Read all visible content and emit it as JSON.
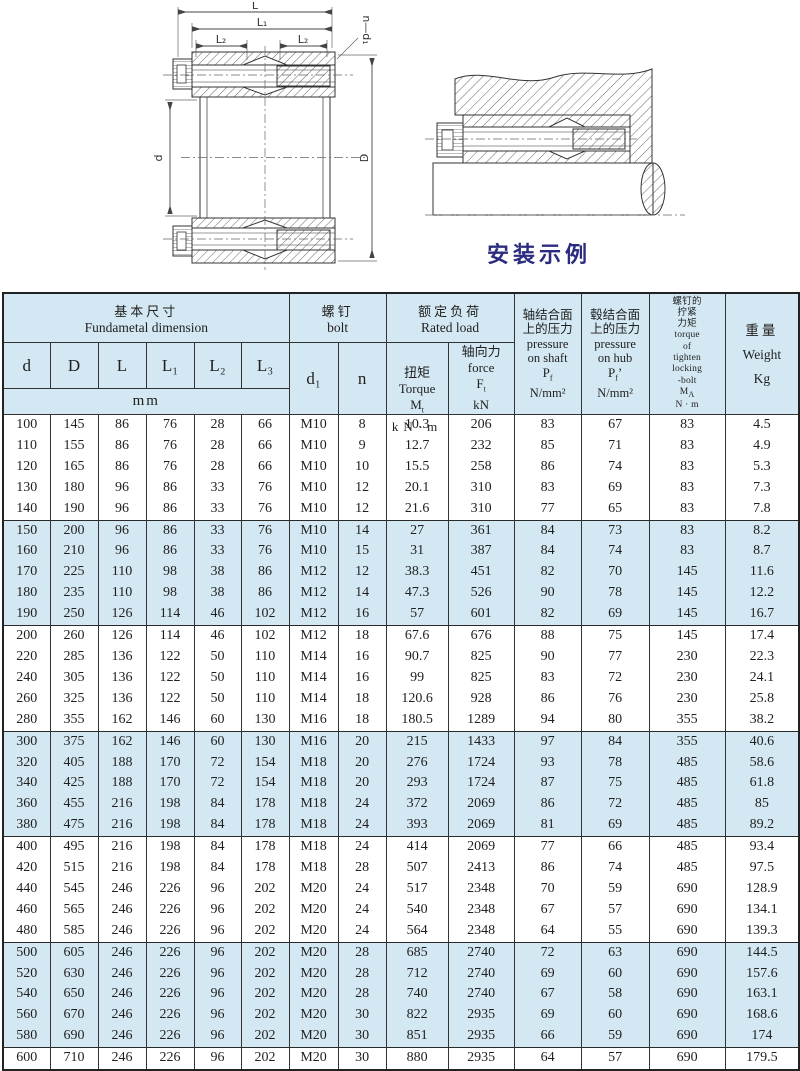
{
  "drawings": {
    "caption": "安装示例"
  },
  "drawing_labels": {
    "L": "L",
    "L1": "L₁",
    "L2": "L₂",
    "L2b": "L₂",
    "L3": "L₃",
    "n_d1": "n—d₁",
    "d": "d",
    "D": "D"
  },
  "table": {
    "col_keys": [
      "d",
      "D",
      "L",
      "L1",
      "L2",
      "L3",
      "d1",
      "n",
      "torque",
      "force",
      "p_shaft",
      "p_hub",
      "ma",
      "weight"
    ],
    "header": {
      "basic": {
        "zh": "基本尺寸",
        "en": "Fundametal  dimension"
      },
      "dims": [
        "d",
        "D",
        "L",
        "L₁",
        "L₂",
        "L₃"
      ],
      "mm": "mm",
      "bolt": {
        "zh": "螺钉",
        "en": "bolt",
        "d1": "d₁",
        "n": "n"
      },
      "rated": {
        "zh": "额定负荷",
        "en": "Rated load"
      },
      "torque": {
        "zh": "扭矩",
        "en": "Torque",
        "sym": {
          "base": "M",
          "sub": "t"
        },
        "unit": "kN·m"
      },
      "force": {
        "zh": "轴向力",
        "en": "force",
        "sym": {
          "base": "F",
          "sub": "t"
        },
        "unit": "kN"
      },
      "p_shaft": {
        "lines": [
          "轴结合面",
          "上的压力",
          "pressure",
          "on shaft"
        ],
        "sym": {
          "base": "P",
          "sub": "f"
        },
        "unit": "N/mm²"
      },
      "p_hub": {
        "lines": [
          "毂结合面",
          "上的压力",
          "pressure",
          "on hub"
        ],
        "sym": {
          "base": "P",
          "sub": "f",
          "after": "’"
        },
        "unit": "N/mm²"
      },
      "bolt_torque": {
        "lines": [
          "螺钉的",
          "拧紧",
          "力矩",
          "torque",
          "of",
          "tighten",
          "locking",
          "-bolt"
        ],
        "sym": {
          "base": "M",
          "sub": "A"
        },
        "unit": "N · m"
      },
      "weight": {
        "zh": "重量",
        "en": "Weight",
        "unit": "Kg"
      }
    },
    "rows": [
      [
        100,
        145,
        86,
        76,
        28,
        66,
        "M10",
        8,
        "10.3",
        206,
        83,
        67,
        83,
        "4.5"
      ],
      [
        110,
        155,
        86,
        76,
        28,
        66,
        "M10",
        9,
        "12.7",
        232,
        85,
        71,
        83,
        "4.9"
      ],
      [
        120,
        165,
        86,
        76,
        28,
        66,
        "M10",
        10,
        "15.5",
        258,
        86,
        74,
        83,
        "5.3"
      ],
      [
        130,
        180,
        96,
        86,
        33,
        76,
        "M10",
        12,
        "20.1",
        310,
        83,
        69,
        83,
        "7.3"
      ],
      [
        140,
        190,
        96,
        86,
        33,
        76,
        "M10",
        12,
        "21.6",
        310,
        77,
        65,
        83,
        "7.8"
      ],
      [
        150,
        200,
        96,
        86,
        33,
        76,
        "M10",
        14,
        "27",
        361,
        84,
        73,
        83,
        "8.2"
      ],
      [
        160,
        210,
        96,
        86,
        33,
        76,
        "M10",
        15,
        "31",
        387,
        84,
        74,
        83,
        "8.7"
      ],
      [
        170,
        225,
        110,
        98,
        38,
        86,
        "M12",
        12,
        "38.3",
        451,
        82,
        70,
        145,
        "11.6"
      ],
      [
        180,
        235,
        110,
        98,
        38,
        86,
        "M12",
        14,
        "47.3",
        526,
        90,
        78,
        145,
        "12.2"
      ],
      [
        190,
        250,
        126,
        114,
        46,
        102,
        "M12",
        16,
        "57",
        601,
        82,
        69,
        145,
        "16.7"
      ],
      [
        200,
        260,
        126,
        114,
        46,
        102,
        "M12",
        18,
        "67.6",
        676,
        88,
        75,
        145,
        "17.4"
      ],
      [
        220,
        285,
        136,
        122,
        50,
        110,
        "M14",
        16,
        "90.7",
        825,
        90,
        77,
        230,
        "22.3"
      ],
      [
        240,
        305,
        136,
        122,
        50,
        110,
        "M14",
        16,
        "99",
        825,
        83,
        72,
        230,
        "24.1"
      ],
      [
        260,
        325,
        136,
        122,
        50,
        110,
        "M14",
        18,
        "120.6",
        928,
        86,
        76,
        230,
        "25.8"
      ],
      [
        280,
        355,
        162,
        146,
        60,
        130,
        "M16",
        18,
        "180.5",
        1289,
        94,
        80,
        355,
        "38.2"
      ],
      [
        300,
        375,
        162,
        146,
        60,
        130,
        "M16",
        20,
        "215",
        1433,
        97,
        84,
        355,
        "40.6"
      ],
      [
        320,
        405,
        188,
        170,
        72,
        154,
        "M18",
        20,
        "276",
        1724,
        93,
        78,
        485,
        "58.6"
      ],
      [
        340,
        425,
        188,
        170,
        72,
        154,
        "M18",
        20,
        "293",
        1724,
        87,
        75,
        485,
        "61.8"
      ],
      [
        360,
        455,
        216,
        198,
        84,
        178,
        "M18",
        24,
        "372",
        2069,
        86,
        72,
        485,
        "85"
      ],
      [
        380,
        475,
        216,
        198,
        84,
        178,
        "M18",
        24,
        "393",
        2069,
        81,
        69,
        485,
        "89.2"
      ],
      [
        400,
        495,
        216,
        198,
        84,
        178,
        "M18",
        24,
        "414",
        2069,
        77,
        66,
        485,
        "93.4"
      ],
      [
        420,
        515,
        216,
        198,
        84,
        178,
        "M18",
        28,
        "507",
        2413,
        86,
        74,
        485,
        "97.5"
      ],
      [
        440,
        545,
        246,
        226,
        96,
        202,
        "M20",
        24,
        "517",
        2348,
        70,
        59,
        690,
        "128.9"
      ],
      [
        460,
        565,
        246,
        226,
        96,
        202,
        "M20",
        24,
        "540",
        2348,
        67,
        57,
        690,
        "134.1"
      ],
      [
        480,
        585,
        246,
        226,
        96,
        202,
        "M20",
        24,
        "564",
        2348,
        64,
        55,
        690,
        "139.3"
      ],
      [
        500,
        605,
        246,
        226,
        96,
        202,
        "M20",
        28,
        "685",
        2740,
        72,
        63,
        690,
        "144.5"
      ],
      [
        520,
        630,
        246,
        226,
        96,
        202,
        "M20",
        28,
        "712",
        2740,
        69,
        60,
        690,
        "157.6"
      ],
      [
        540,
        650,
        246,
        226,
        96,
        202,
        "M20",
        28,
        "740",
        2740,
        67,
        58,
        690,
        "163.1"
      ],
      [
        560,
        670,
        246,
        226,
        96,
        202,
        "M20",
        30,
        "822",
        2935,
        69,
        60,
        690,
        "168.6"
      ],
      [
        580,
        690,
        246,
        226,
        96,
        202,
        "M20",
        30,
        "851",
        2935,
        66,
        59,
        690,
        "174"
      ],
      [
        600,
        710,
        246,
        226,
        96,
        202,
        "M20",
        30,
        "880",
        2935,
        64,
        57,
        690,
        "179.5"
      ]
    ]
  }
}
